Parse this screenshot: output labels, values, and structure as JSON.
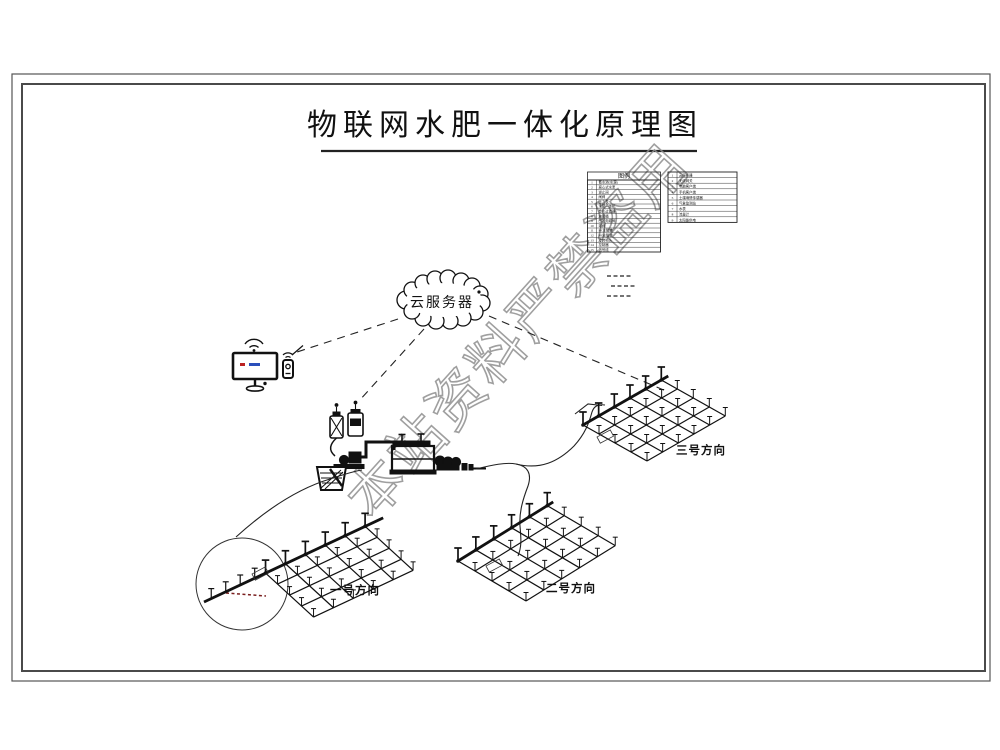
{
  "title": "物联网水肥一体化原理图",
  "watermark": "本站资料严禁盗用",
  "cloud_label": "云服务器",
  "legend": {
    "header": "图例",
    "left_items": [
      {
        "no": "1",
        "label": "蓄水池(水源)"
      },
      {
        "no": "2",
        "label": "离心式水泵"
      },
      {
        "no": "3",
        "label": "逆止阀"
      },
      {
        "no": "4",
        "label": "闸阀"
      },
      {
        "no": "5",
        "label": "压力表"
      },
      {
        "no": "6",
        "label": "水肥一体机"
      },
      {
        "no": "7",
        "label": "叠片过滤器"
      },
      {
        "no": "8",
        "label": "施肥桶"
      },
      {
        "no": "9",
        "label": "田间电磁阀"
      },
      {
        "no": "10",
        "label": "球阀"
      },
      {
        "no": "11",
        "label": "PE主管道"
      },
      {
        "no": "12",
        "label": "PE支管道"
      },
      {
        "no": "13",
        "label": "旋转喷头"
      },
      {
        "no": "14",
        "label": "控制器"
      },
      {
        "no": "15",
        "label": "信号线"
      }
    ],
    "right_items": [
      {
        "no": "1",
        "label": "云服务器"
      },
      {
        "no": "2",
        "label": "无线网关"
      },
      {
        "no": "3",
        "label": "电脑客户端"
      },
      {
        "no": "4",
        "label": "手机客户端"
      },
      {
        "no": "5",
        "label": "土壤墒情传感器"
      },
      {
        "no": "6",
        "label": "气象监测站"
      },
      {
        "no": "7",
        "label": "水表"
      },
      {
        "no": "8",
        "label": "流量计"
      },
      {
        "no": "9",
        "label": "太阳能供电"
      }
    ]
  },
  "field_labels": {
    "f1": "一号方向",
    "f2": "二号方向",
    "f3": "三号方向"
  },
  "colors": {
    "line": "#1a1a1a",
    "watermark": "#8f8f8f",
    "accent_red": "#bb2222",
    "accent_blue": "#2a4fbb",
    "detail_red": "#7a1f1f"
  }
}
